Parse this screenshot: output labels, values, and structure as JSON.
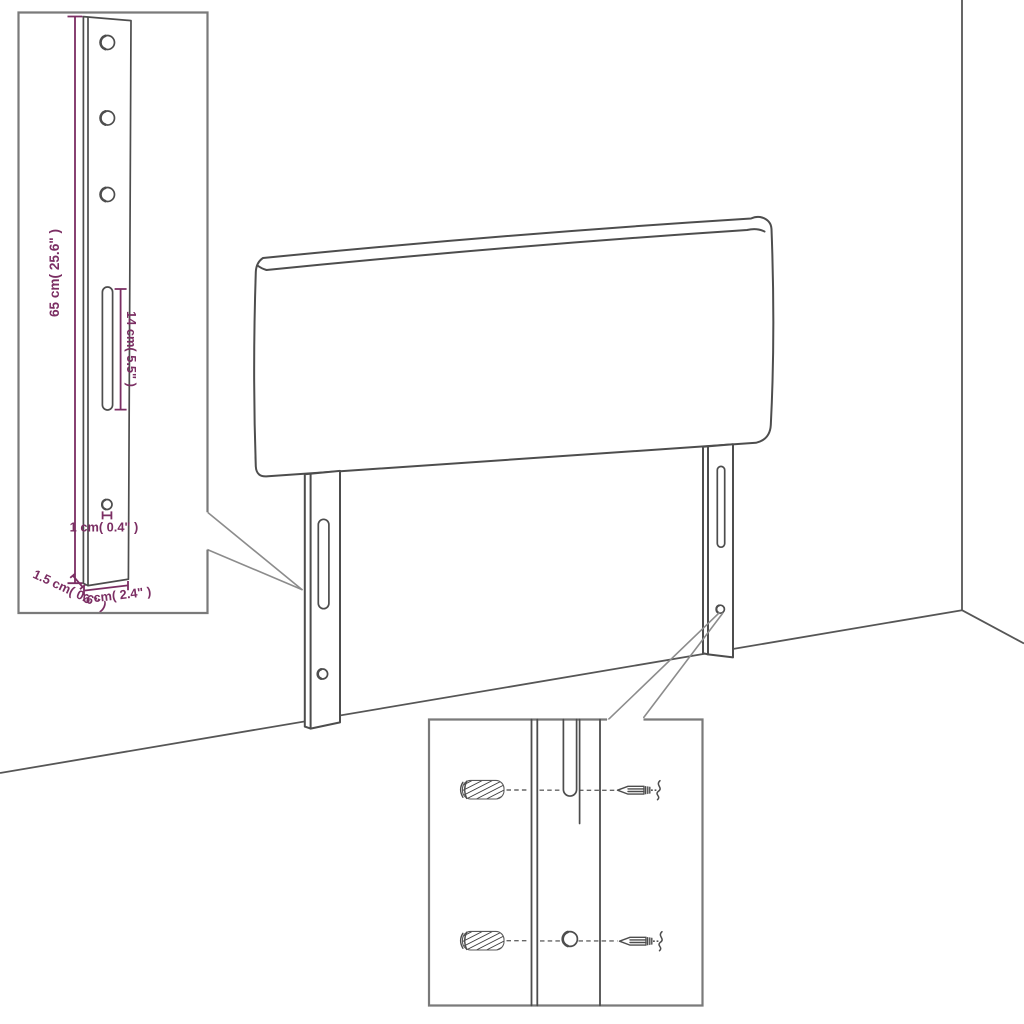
{
  "diagram": {
    "measurements": {
      "leg_height": "65 cm( 25.6\" )",
      "slot_length": "14 cm( 5.5\" )",
      "hole_diameter": "1 cm( 0.4\" )",
      "leg_thickness": "1.5 cm( 0.6\" )",
      "leg_width": "6 cm( 2.4\" )"
    },
    "colors": {
      "dimension": "#7B2E63",
      "line": "#4D4D4D",
      "border": "#7A7A7A",
      "leader": "#8C8C8C",
      "background": "#FFFFFF"
    }
  }
}
